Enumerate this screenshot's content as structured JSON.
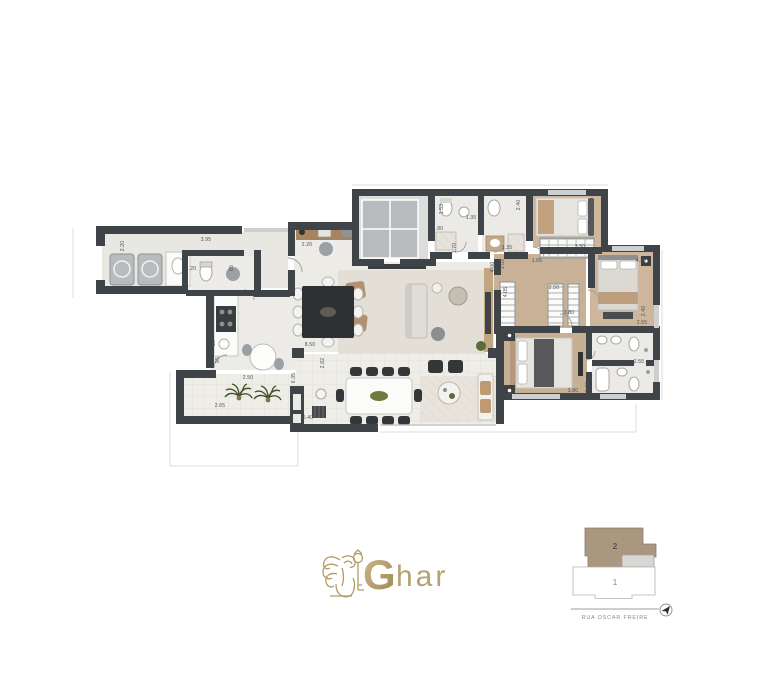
{
  "floorplan": {
    "dimensions": [
      {
        "t": "2.20",
        "x": 124,
        "y": 246,
        "r": 270
      },
      {
        "t": "3.95",
        "x": 206,
        "y": 241,
        "r": 0
      },
      {
        "t": "2.20",
        "x": 191,
        "y": 270,
        "r": 0
      },
      {
        "t": "85",
        "x": 233,
        "y": 268,
        "r": 270
      },
      {
        "t": "2.20",
        "x": 307,
        "y": 246,
        "r": 0
      },
      {
        "t": "1.53",
        "x": 443,
        "y": 209,
        "r": 270
      },
      {
        "t": "1.35",
        "x": 471,
        "y": 219,
        "r": 0
      },
      {
        "t": "1.80",
        "x": 438,
        "y": 230,
        "r": 0
      },
      {
        "t": "1.70",
        "x": 456,
        "y": 248,
        "r": 270
      },
      {
        "t": "2.40",
        "x": 520,
        "y": 205,
        "r": 270
      },
      {
        "t": "1.35",
        "x": 507,
        "y": 249,
        "r": 0
      },
      {
        "t": "4.00",
        "x": 494,
        "y": 267,
        "r": 270
      },
      {
        "t": "1.02",
        "x": 504,
        "y": 264,
        "r": 270
      },
      {
        "t": "1.65",
        "x": 537,
        "y": 262,
        "r": 0
      },
      {
        "t": "3.50",
        "x": 580,
        "y": 248,
        "r": 0
      },
      {
        "t": "4.30",
        "x": 641,
        "y": 262,
        "r": 0
      },
      {
        "t": "2.50",
        "x": 554,
        "y": 289,
        "r": 0
      },
      {
        "t": "3.80",
        "x": 569,
        "y": 314,
        "r": 0
      },
      {
        "t": "4.05",
        "x": 507,
        "y": 292,
        "r": 270
      },
      {
        "t": "2.40",
        "x": 645,
        "y": 311,
        "r": 270
      },
      {
        "t": "2.55",
        "x": 642,
        "y": 324,
        "r": 0
      },
      {
        "t": "2.55",
        "x": 639,
        "y": 363,
        "r": 0
      },
      {
        "t": "3.80",
        "x": 573,
        "y": 392,
        "r": 0
      },
      {
        "t": "1.60",
        "x": 589,
        "y": 387,
        "r": 270
      },
      {
        "t": "8.50",
        "x": 310,
        "y": 346,
        "r": 0
      },
      {
        "t": "2.82",
        "x": 324,
        "y": 363,
        "r": 270
      },
      {
        "t": "6.35",
        "x": 295,
        "y": 378,
        "r": 270
      },
      {
        "t": "2.50",
        "x": 248,
        "y": 379,
        "r": 0
      },
      {
        "t": "95",
        "x": 219,
        "y": 360,
        "r": 270
      },
      {
        "t": "36",
        "x": 215,
        "y": 343,
        "r": 270
      },
      {
        "t": "2.65",
        "x": 220,
        "y": 407,
        "r": 0
      },
      {
        "t": "6.40",
        "x": 308,
        "y": 419,
        "r": 0
      }
    ]
  },
  "logo": {
    "initial": "G",
    "rest": "har"
  },
  "keyplan": {
    "upper_unit_label": "2",
    "lower_unit_label": "1",
    "street_label": "RUA OSCAR FREIRE"
  },
  "colors": {
    "wall": "#3f4448",
    "wood_floor": "#c9b197",
    "light_floor": "#edebe6",
    "logo_gold": "#b49a63",
    "keyplan_unit_fill": "#a99780"
  }
}
